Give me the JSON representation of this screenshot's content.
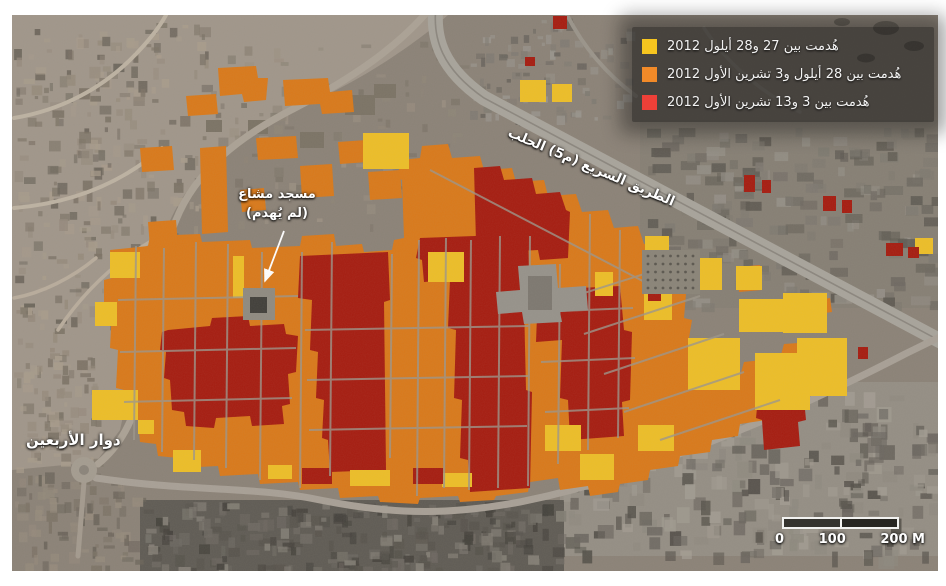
{
  "page": {
    "background": "#ffffff"
  },
  "legend": {
    "background": "rgba(14,14,14,0.55)",
    "items": [
      {
        "key": "demolished-27-28-september",
        "color": "#f6c51f",
        "label": "هُدمت بين 27 و28 أيلول 2012"
      },
      {
        "key": "demolished-28sep-3-october",
        "color": "#f28a28",
        "label": "هُدمت بين 28 أيلول و3 تشرين الأول 2012"
      },
      {
        "key": "demolished-3-13-october",
        "color": "#ee4038",
        "label": "هُدمت بين 3 و13 تشرين الأول 2012"
      }
    ]
  },
  "labels": {
    "highway": "الطريق السريع (م5) الحلب",
    "mosque": {
      "line1": "مسجد مشاع",
      "line2": "(لم يُهدم)"
    },
    "roundabout": "دوار الأربعين"
  },
  "scale_bar": {
    "tick0": "0",
    "tick1": "100",
    "tick2": "200 M"
  },
  "map": {
    "overlay_colors": {
      "yellow": "#edbe27",
      "orange": "#d9791a",
      "red": "#a61c10"
    },
    "regions": {
      "orange_paths": [
        "M104,280 L112,278 L110,250 L148,246 L150,236 L200,234 L202,242 L250,240 L252,248 L300,246 L302,236 L334,234 L336,246 L362,244 L364,252 L392,250 L394,240 L404,238 L402,180 L398,178 L400,160 L420,158 L422,146 L448,144 L452,158 L480,156 L484,170 L512,168 L516,182 L544,180 L548,196 L576,194 L582,212 L608,210 L614,228 L638,226 L644,244 L664,242 L670,260 L682,262 L678,292 L686,294 L684,318 L692,320 L688,344 L700,346 L702,380 L740,376 L744,362 L780,358 L784,344 L812,342 L810,368 L798,370 L800,388 L786,390 L788,404 L768,408 L766,420 L740,424 L738,436 L712,440 L710,452 L680,456 L678,466 L650,470 L648,480 L620,484 L618,492 L590,496 L588,486 L560,490 L558,478 L530,482 L528,492 L496,496 L494,500 L460,502 L458,496 L420,498 L418,504 L380,502 L378,496 L340,498 L338,488 L300,490 L298,482 L260,484 L258,474 L220,476 L218,466 L180,468 L178,458 L158,456 L156,444 L140,442 L138,420 L126,418 L124,390 L116,388 L118,350 L110,348 L112,310 L104,308 Z",
        "M218,68 L256,66 L258,78 L268,78 L266,100 L244,102 L242,94 L220,96 Z",
        "M186,96 L216,94 L218,114 L188,116 Z",
        "M283,80 L328,78 L330,92 L352,90 L354,112 L322,114 L320,104 L285,106 Z",
        "M338,142 L366,140 L368,162 L340,164 Z",
        "M256,138 L296,136 L298,158 L258,160 Z",
        "M140,148 L172,146 L174,170 L142,172 Z",
        "M200,148 L226,146 L228,232 L202,234 Z",
        "M148,222 L176,220 L178,246 L150,248 Z",
        "M240,190 L264,188 L266,210 L242,212 Z",
        "M300,166 L332,164 L334,196 L302,198 Z",
        "M368,172 L400,170 L402,198 L370,200 Z",
        "M390,298 L416,296 L418,360 L412,362 L414,430 L408,432 L410,458 L392,460 L390,430 L384,428 L386,330 Z",
        "M737,267 L760,265 L762,290 L739,292 Z",
        "M816,300 L830,298 L832,312 L818,314 Z"
      ],
      "red_paths": [
        "M300,256 L388,252 L390,300 L384,302 L386,470 L330,472 L328,440 L322,438 L324,400 L316,398 L318,352 L310,350 L312,300 L298,298 Z",
        "M420,238 L528,234 L530,300 L524,302 L526,390 L532,392 L530,488 L470,492 L468,460 L460,458 L462,400 L454,398 L456,330 L448,328 L450,280 L424,282 L422,260 L416,258 Z",
        "M474,168 L500,166 L504,180 L532,178 L536,194 L560,192 L566,210 L570,212 L568,258 L540,260 L538,250 L500,252 L498,240 L476,242 Z",
        "M538,290 L620,286 L624,330 L632,332 L630,400 L622,402 L624,436 L570,440 L568,400 L560,398 L562,340 L536,342 Z",
        "M168,330 L210,326 L212,318 L248,316 L250,326 L284,324 L286,334 L298,336 L296,372 L288,374 L290,404 L282,406 L284,424 L252,426 L250,416 L216,418 L214,428 L186,426 L184,412 L172,410 L170,380 L164,378 L166,352 L160,350 L162,332 Z",
        "M760,382 L802,378 L806,420 L798,422 L800,446 L764,450 L762,420 L756,418 L758,398 Z"
      ],
      "red_rects": [
        [
          553,
          16,
          14,
          13
        ],
        [
          525,
          57,
          10,
          9
        ],
        [
          744,
          175,
          11,
          17
        ],
        [
          762,
          180,
          9,
          13
        ],
        [
          823,
          196,
          13,
          15
        ],
        [
          842,
          200,
          10,
          13
        ],
        [
          886,
          243,
          17,
          13
        ],
        [
          908,
          247,
          11,
          11
        ],
        [
          858,
          347,
          10,
          12
        ],
        [
          648,
          290,
          13,
          11
        ],
        [
          302,
          468,
          30,
          16
        ],
        [
          413,
          468,
          30,
          16
        ]
      ],
      "yellow_rects": [
        [
          110,
          252,
          30,
          26
        ],
        [
          92,
          390,
          46,
          30
        ],
        [
          95,
          302,
          22,
          24
        ],
        [
          138,
          420,
          16,
          14
        ],
        [
          173,
          450,
          28,
          22
        ],
        [
          233,
          256,
          11,
          42
        ],
        [
          363,
          133,
          46,
          36
        ],
        [
          428,
          252,
          36,
          30
        ],
        [
          520,
          80,
          26,
          22
        ],
        [
          552,
          84,
          20,
          18
        ],
        [
          595,
          272,
          18,
          24
        ],
        [
          645,
          236,
          24,
          22
        ],
        [
          688,
          258,
          34,
          32
        ],
        [
          736,
          266,
          26,
          24
        ],
        [
          644,
          293,
          28,
          27
        ],
        [
          739,
          299,
          52,
          33
        ],
        [
          783,
          293,
          44,
          40
        ],
        [
          797,
          338,
          50,
          58
        ],
        [
          688,
          338,
          52,
          52
        ],
        [
          755,
          353,
          55,
          57
        ],
        [
          915,
          238,
          18,
          16
        ],
        [
          545,
          425,
          36,
          26
        ],
        [
          580,
          454,
          34,
          26
        ],
        [
          638,
          425,
          36,
          26
        ],
        [
          268,
          465,
          24,
          14
        ],
        [
          350,
          470,
          40,
          16
        ],
        [
          442,
          473,
          30,
          14
        ]
      ]
    }
  }
}
